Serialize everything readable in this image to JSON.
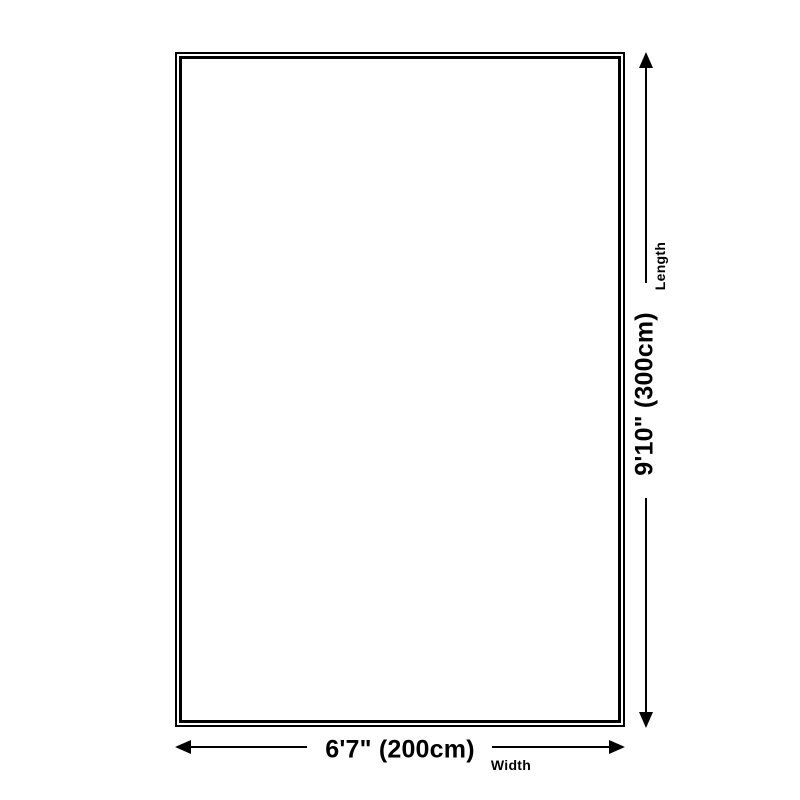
{
  "dimension_diagram": {
    "shape": "rectangle",
    "width": {
      "value": "6'7\" (200cm)",
      "label": "Width"
    },
    "length": {
      "value": "9'10\" (300cm)",
      "label": "Length"
    }
  },
  "icons": {
    "up-arrowhead": "filled triangle pointing up",
    "down-arrowhead": "filled triangle pointing down",
    "left-arrowhead": "filled triangle pointing left",
    "right-arrowhead": "filled triangle pointing right"
  },
  "colors": {
    "foreground": "#000000",
    "background": "#ffffff"
  }
}
